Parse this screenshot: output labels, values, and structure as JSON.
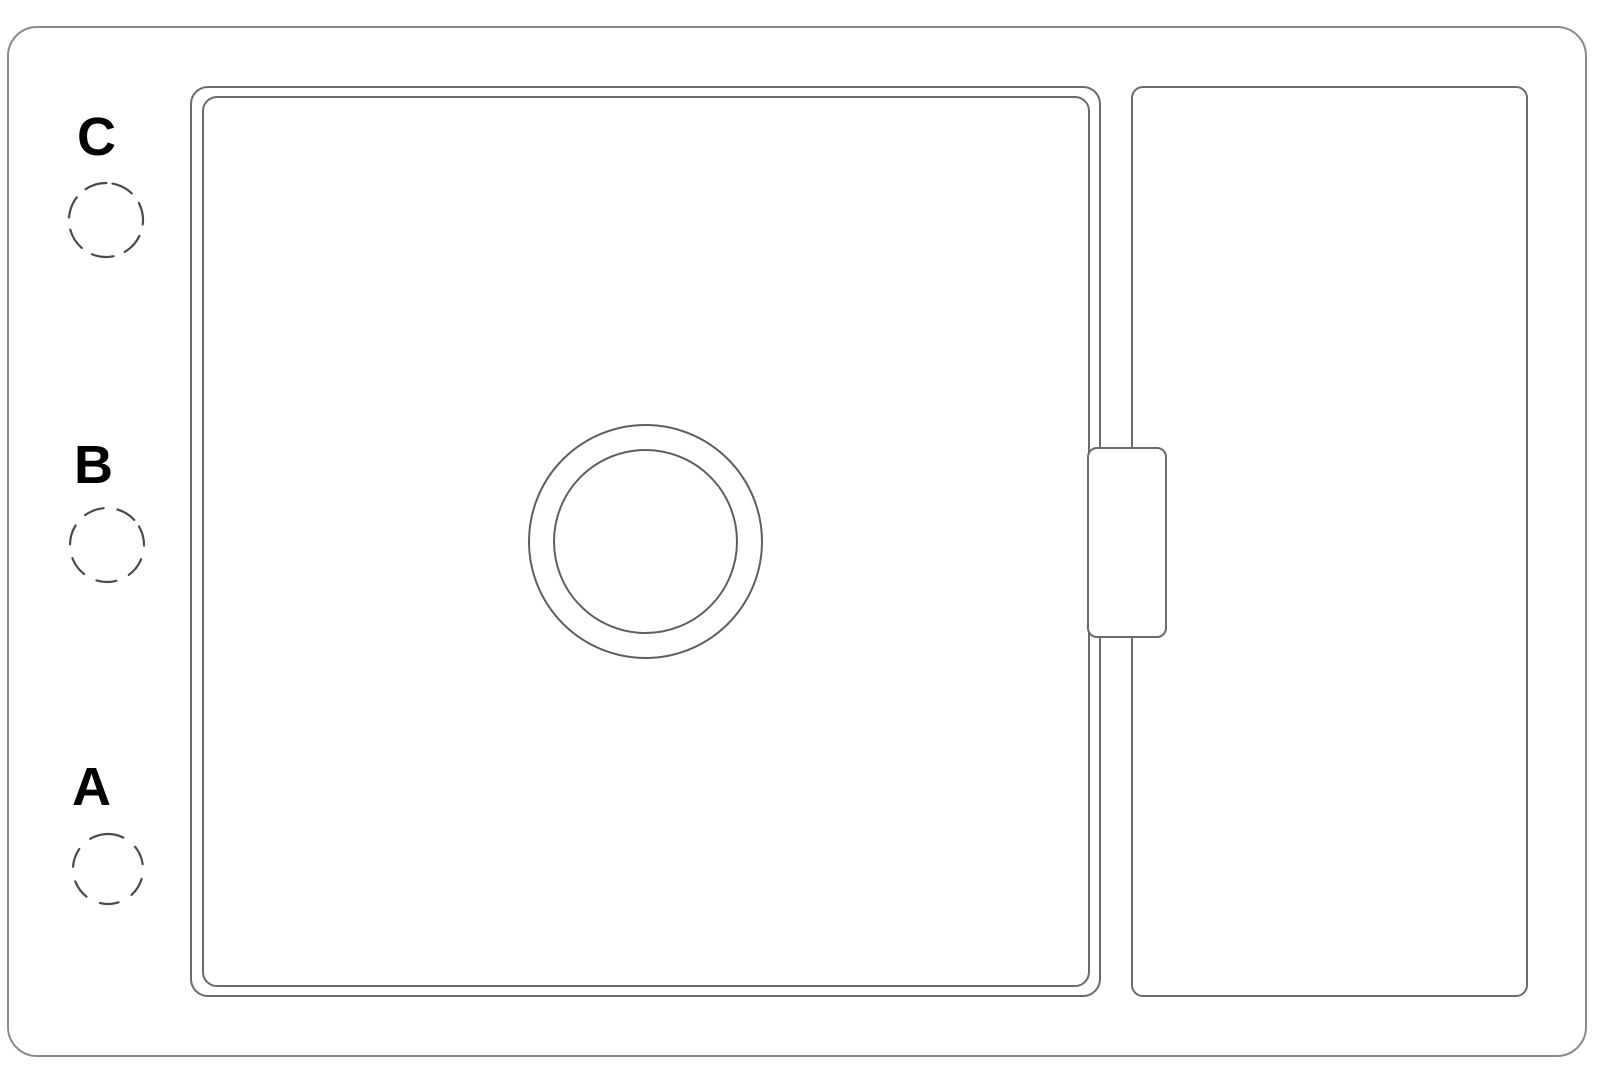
{
  "figure": {
    "position_labels": [
      {
        "key": "c",
        "text": "C"
      },
      {
        "key": "b",
        "text": "B"
      },
      {
        "key": "a",
        "text": "A"
      }
    ],
    "colors": {
      "background": "#ffffff",
      "frame_line": "#8a8a8a",
      "drawing_line": "#6b6b6b",
      "drain_line": "#5f5f5f",
      "label_text": "#000000"
    }
  }
}
